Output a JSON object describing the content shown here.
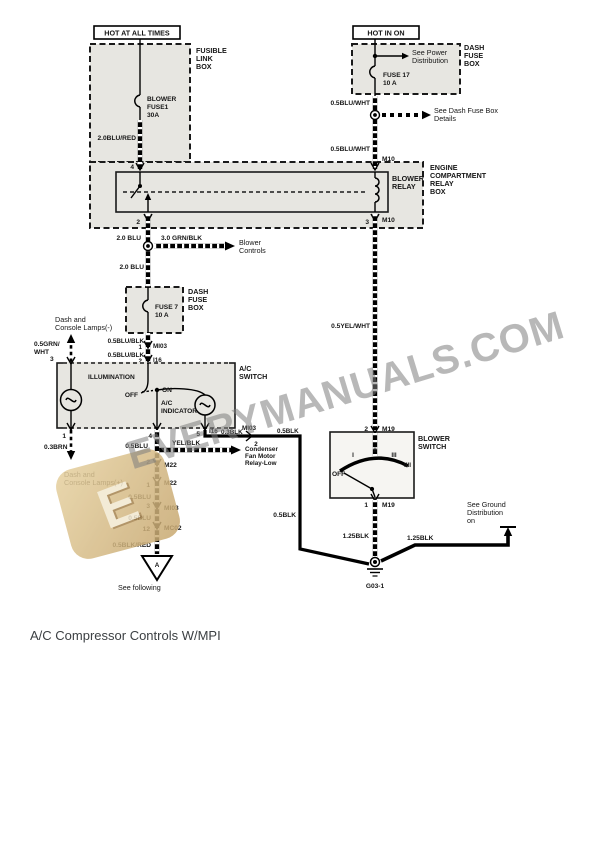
{
  "caption": "A/C Compressor Controls W/MPI",
  "watermark": {
    "text": "EVERYMANUALS.COM",
    "logo_letter": "E",
    "logo_color": "#d5b87e",
    "text_color": "#7d7d7d"
  },
  "power_labels": {
    "hot_at_all_times": "HOT AT ALL TIMES",
    "hot_in_on": "HOT IN ON"
  },
  "boxes": {
    "fusible_link": {
      "lines": [
        "FUSIBLE",
        "LINK",
        "BOX"
      ]
    },
    "dash_fuse_top": {
      "lines": [
        "DASH",
        "FUSE",
        "BOX"
      ]
    },
    "engine_relay": {
      "lines": [
        "ENGINE",
        "COMPARTMENT",
        "RELAY",
        "BOX"
      ]
    },
    "blower_relay": {
      "lines": [
        "BLOWER",
        "RELAY"
      ]
    },
    "dash_fuse_mid": {
      "lines": [
        "DASH",
        "FUSE",
        "BOX"
      ]
    },
    "ac_switch": {
      "lines": [
        "A/C",
        "SWITCH"
      ]
    },
    "blower_switch": {
      "lines": [
        "BLOWER",
        "SWITCH"
      ]
    }
  },
  "fuses": {
    "blower_fuse": {
      "lines": [
        "BLOWER",
        "FUSE1",
        "30A"
      ]
    },
    "fuse17": {
      "lines": [
        "FUSE 17",
        "10 A"
      ]
    },
    "fuse7": {
      "lines": [
        "FUSE 7",
        "10 A"
      ]
    }
  },
  "wires": {
    "blu_red": "2.0BLU/RED",
    "blu_wht_upper": "0.5BLU/WHT",
    "blu_wht_lower": "0.5BLU/WHT",
    "blu_20_upper": "2.0 BLU",
    "grn_blk": "3.0 GRN/BLK",
    "blu_20_lower": "2.0 BLU",
    "yel_wht": "0.5YEL/WHT",
    "grn_wht": {
      "lines": [
        "0.5GRN/",
        "WHT"
      ]
    },
    "blu_blk_1": "0.5BLU/BLK",
    "blu_blk_2": "0.5BLU/BLK",
    "brn": "0.3BRN",
    "blu_a": "0.5BLU",
    "yel_blk": "YEL/BLK",
    "blk_03": "0.3BLK",
    "blk_05_a": "0.5BLK",
    "blu_b": "0.5BLU",
    "blu_c": "0.5BLU",
    "blk_05_b": "0.5BLK",
    "blk_red": "0.5BLK/RED",
    "blk_125_left": "1.25BLK",
    "blk_125_right": "1.25BLK"
  },
  "pins": {
    "relay_in": "4",
    "relay_out": "2",
    "relay_coil_top": "M10",
    "relay_coil_bot_pin": "3",
    "relay_coil_bot": "M10",
    "fuse7_out_pin": "1",
    "fuse7_conn": "MI03",
    "acsw_in_pin": "2",
    "acsw_in_conn": "I16",
    "acsw_illum_in": "3",
    "acsw_illum_out": "1",
    "acsw_sw_out": "4",
    "acsw_ind_out_pin": "5",
    "acsw_ind_out_conn": "I16",
    "cond_conn": "MI03",
    "cond_pin": "2",
    "m22_a_pin": "2",
    "m22_a": "M22",
    "m22_b_pin": "1",
    "m22_b": "M22",
    "mi03_pin": "3",
    "mi03": "MI03",
    "mc02_pin": "12",
    "mc02": "MC02",
    "blower_in_pin": "2",
    "blower_in_conn": "M19",
    "blower_out_pin": "1",
    "blower_out_conn": "M19"
  },
  "notes": {
    "see_power": {
      "lines": [
        "See Power",
        "Distribution"
      ]
    },
    "see_dash_fuse": {
      "lines": [
        "See Dash Fuse Box",
        "Details"
      ]
    },
    "blower_controls": {
      "lines": [
        "Blower",
        "Controls"
      ]
    },
    "lamps_minus": {
      "lines": [
        "Dash and",
        "Console Lamps(-)"
      ]
    },
    "lamps_plus": {
      "lines": [
        "Dash and",
        "Console Lamps(+)"
      ]
    },
    "condenser": {
      "lines": [
        "Condenser",
        "Fan Motor",
        "Relay-Low"
      ]
    },
    "see_ground": {
      "lines": [
        "See Ground",
        "Distribution",
        "on"
      ]
    },
    "see_following": "See following",
    "ref_a": "A",
    "ground_id": "G03-1"
  },
  "switch": {
    "illumination": "ILLUMINATION",
    "off": "OFF",
    "on": "ON",
    "ac_indicator": {
      "lines": [
        "A/C",
        "INDICATOR"
      ]
    },
    "blower_off": "OFF",
    "positions": [
      "I",
      "II",
      "III",
      "IIII"
    ]
  }
}
